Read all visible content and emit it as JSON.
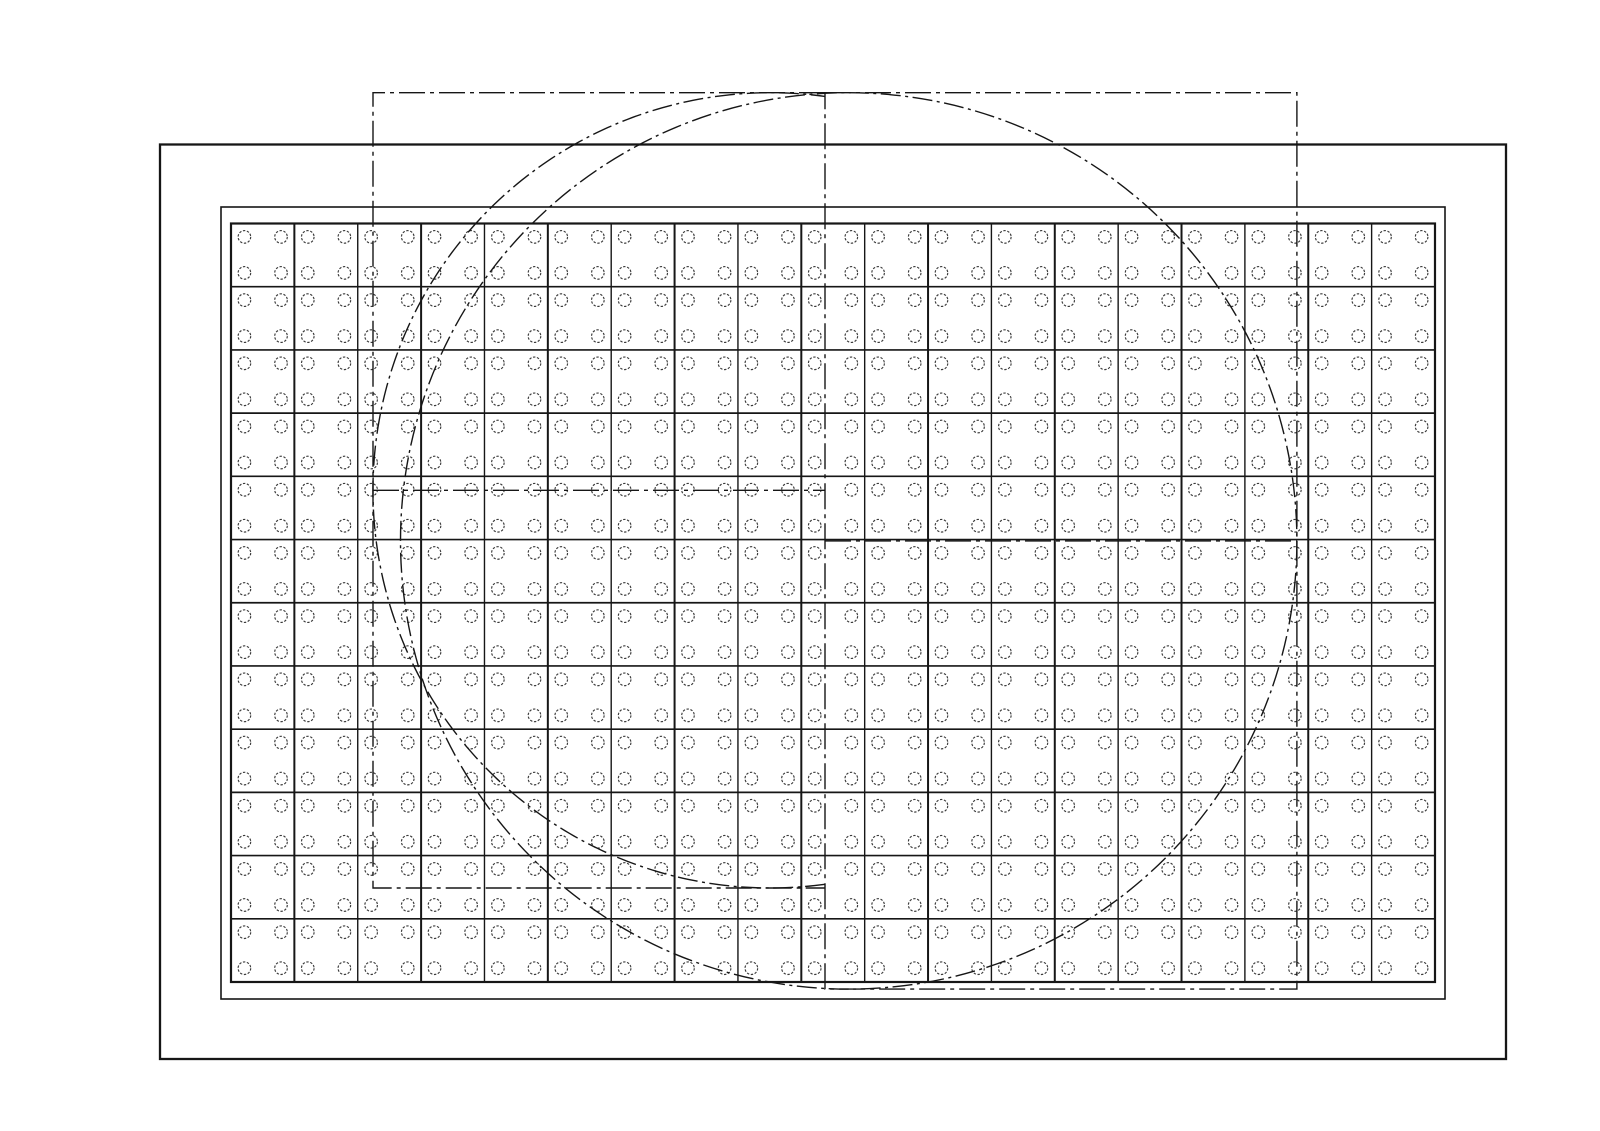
{
  "figure": {
    "kind": "engineering-patent-drawing",
    "description": "rectangular panel with cell grid of holes, two phantom regions and two phantom wafer outlines",
    "viewbox": "0 0 1600 1131",
    "canvas": {
      "width": 1600,
      "height": 1131,
      "background": "#ffffff"
    },
    "colors": {
      "line": "#161616",
      "hole_stroke": "#3a3a3a",
      "cell_fill": "#ffffff"
    },
    "outer_frame": {
      "x": 160,
      "y": 144.5,
      "width": 1346,
      "height": 914.5,
      "stroke_width": 2.3
    },
    "inner_frame": {
      "x": 221,
      "y": 207,
      "width": 1224,
      "height": 792,
      "stroke_width": 1.6
    },
    "grid": {
      "x": 231,
      "y": 223.5,
      "columns": 19,
      "rows": 12,
      "cell_width": 63.368,
      "cell_height": 63.208,
      "border_stroke_width": 2.2,
      "v_line_stroke_width_minor": 1.4,
      "v_line_stroke_width_major": 2.0,
      "h_line_stroke_width": 1.7,
      "holes_per_cell": 4,
      "hole_radius": 6.3,
      "hole_offsets_x": [
        13.4,
        50.0
      ],
      "hole_offsets_y": [
        13.4,
        49.4
      ],
      "hole_stroke_width": 1.15,
      "hole_dash": "2.4 1.6"
    },
    "phantom": {
      "stroke_width": 1.4,
      "line_dash": "26 5 4 5",
      "arc_dash": "20 4.5 3 4.5"
    },
    "region_a": {
      "x1": 373,
      "y1": 92.7,
      "x2": 825,
      "y2": 888,
      "midline_y": 490.35
    },
    "region_b": {
      "x1": 825,
      "y1": 92.7,
      "x2": 1296.9,
      "y2": 989.1,
      "midline_y": 540.9
    },
    "wafer_position_a_arc": {
      "cx": 770.6,
      "cy": 490.35,
      "r": 397.65,
      "start_angle_deg": 82.14,
      "end_angle_deg": 277.86
    },
    "wafer_position_b_circle": {
      "cx": 848.7,
      "cy": 540.9,
      "r": 448.2
    }
  }
}
